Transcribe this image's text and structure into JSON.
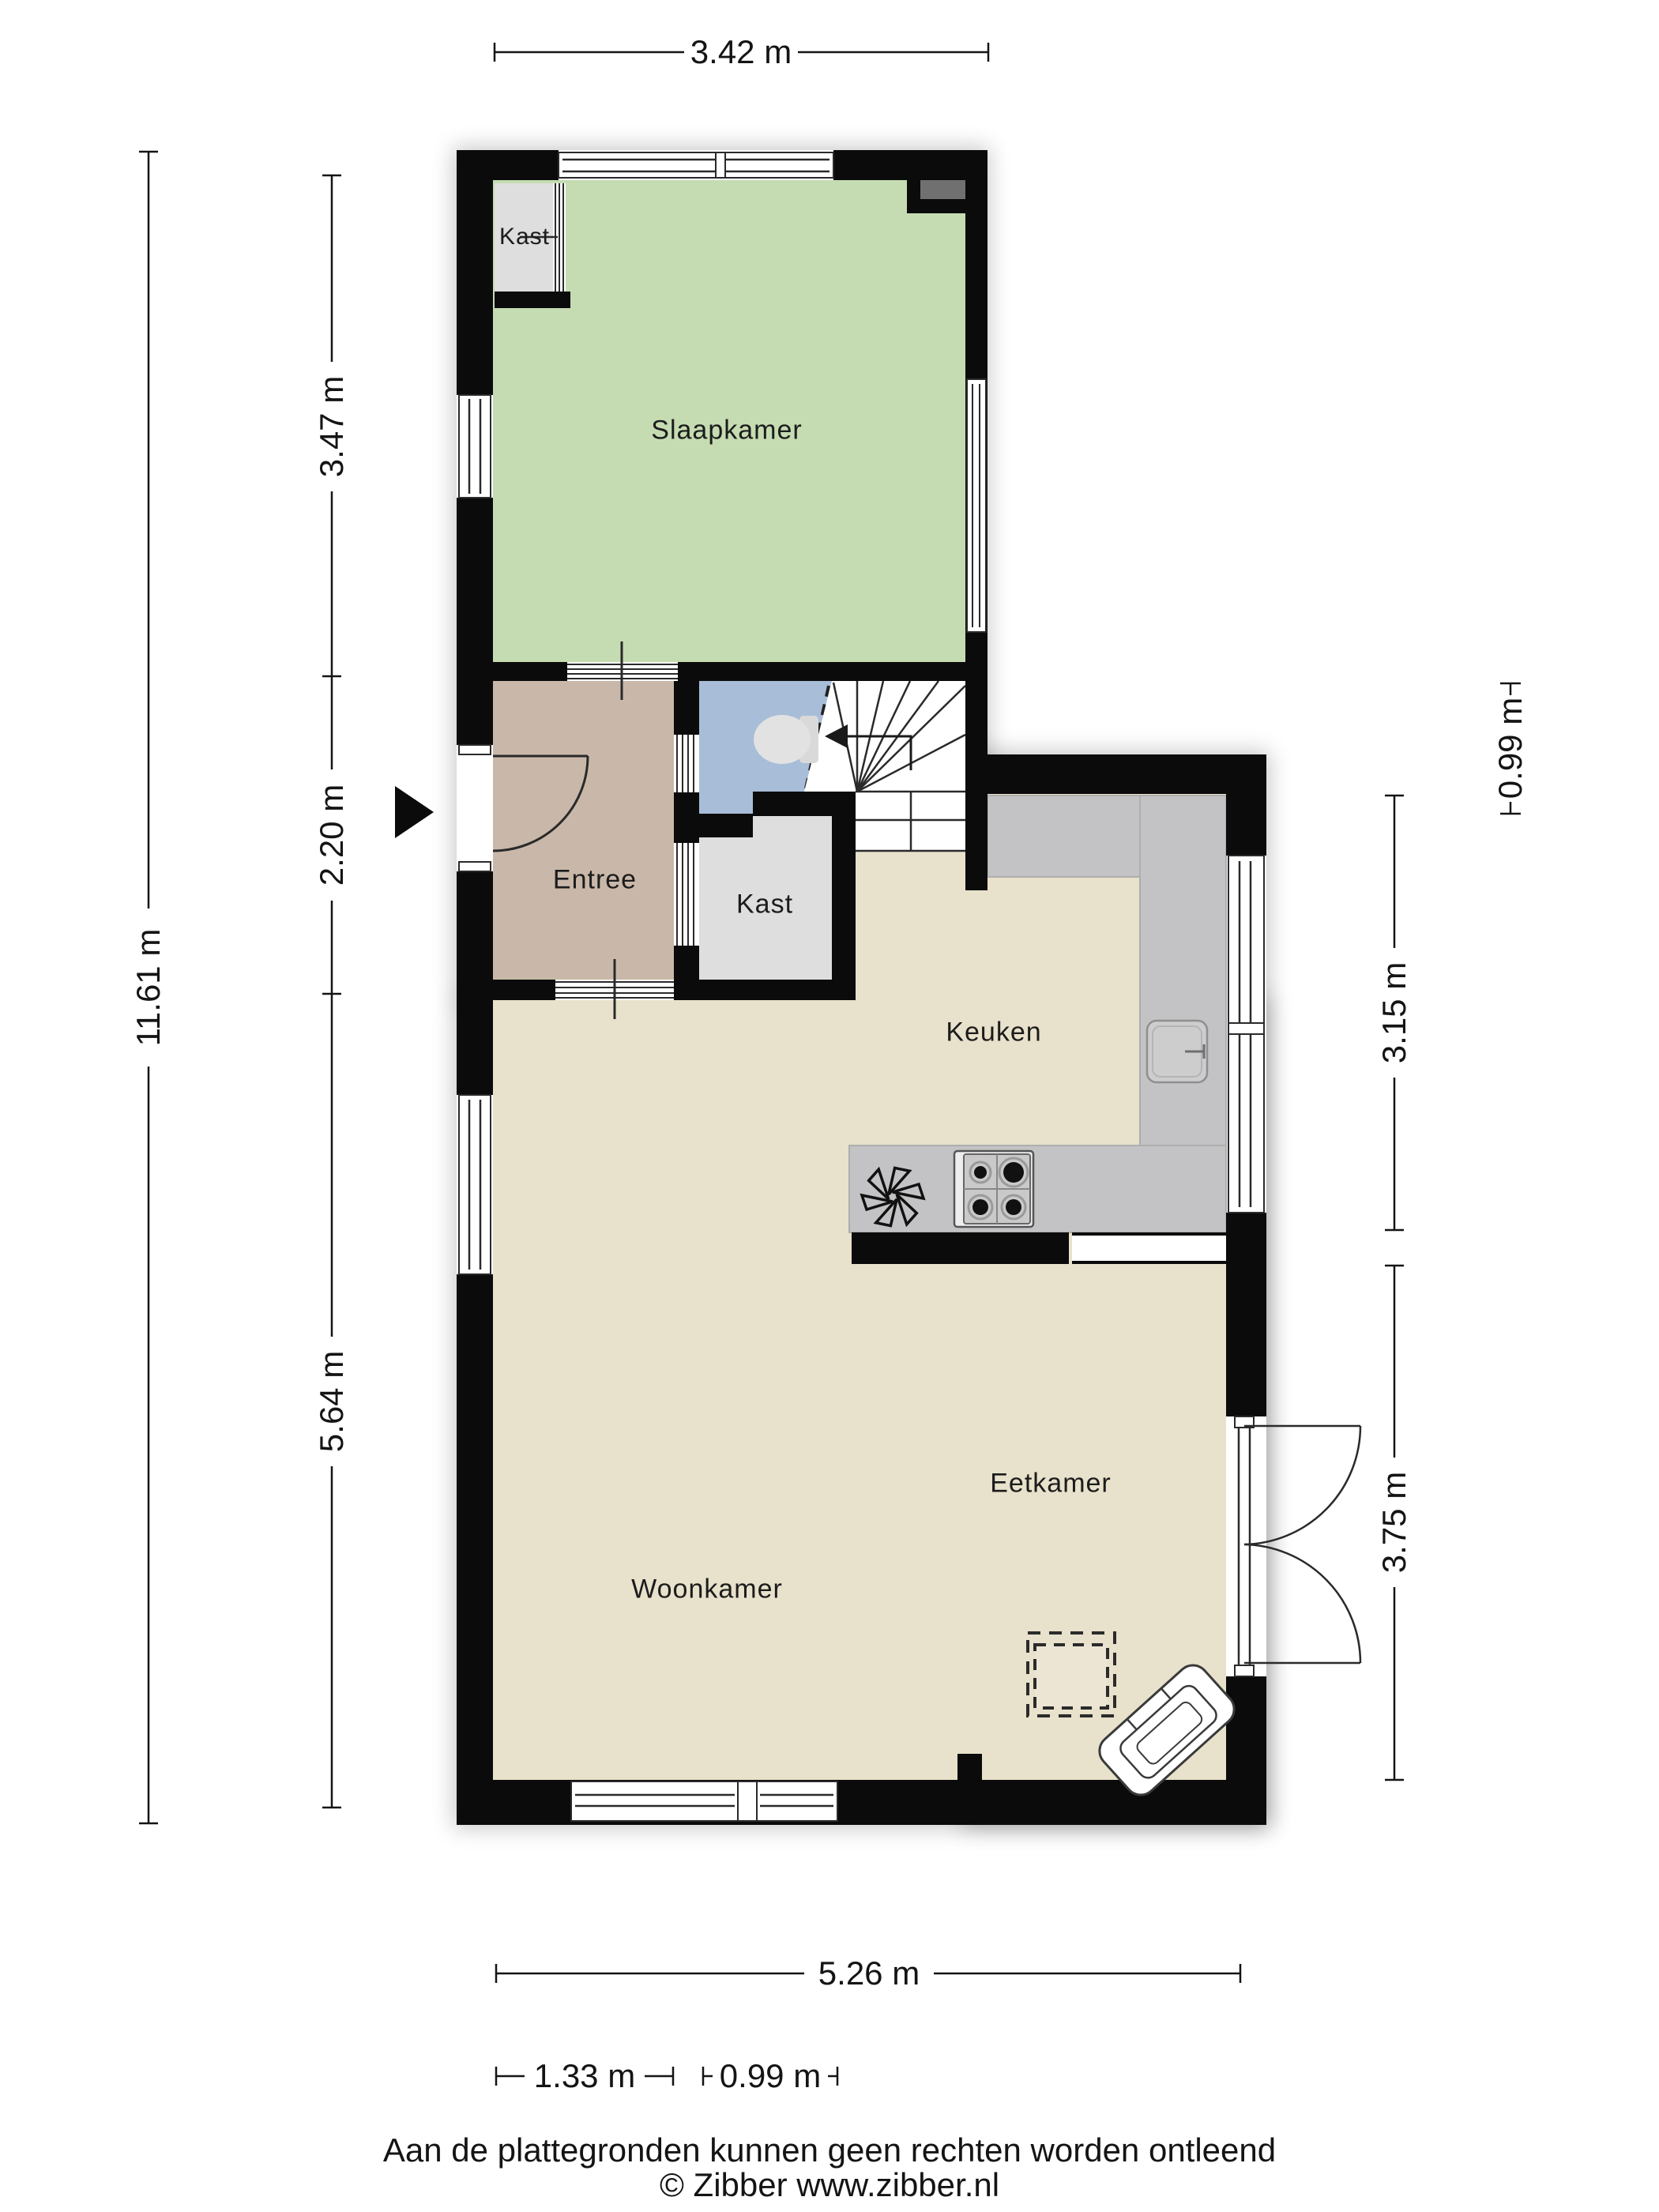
{
  "plan": {
    "type": "floorplan",
    "source_note": "Dutch residential ground floor plan"
  },
  "rooms": {
    "kast_top": "Kast",
    "slaapkamer": "Slaapkamer",
    "entree": "Entree",
    "kast_mid": "Kast",
    "keuken": "Keuken",
    "eetkamer": "Eetkamer",
    "woonkamer": "Woonkamer"
  },
  "dimensions": {
    "top_width": "3.42 m",
    "left_total": "11.61 m",
    "left_top": "3.47 m",
    "left_mid": "2.20 m",
    "left_bottom": "5.64 m",
    "right_kitchen": "3.15 m",
    "right_dining": "3.75 m",
    "right_offset": "0.99 m",
    "bottom_total": "5.26 m",
    "bottom_left": "1.33 m",
    "bottom_mid": "0.99 m"
  },
  "footer": {
    "disclaimer": "Aan de plattegronden kunnen geen rechten worden ontleend",
    "copyright": "© Zibber www.zibber.nl"
  },
  "colors": {
    "wall": "#0b0b0b",
    "bedroom_floor": "#c5dcb2",
    "hall_floor": "#c9b8a9",
    "toilet_floor": "#a8bdd8",
    "closet_floor": "#dedede",
    "living_floor": "#e8e1cb",
    "counter": "#c3c3c5",
    "chimney_inset": "#707070",
    "dimension_text": "#141414"
  }
}
